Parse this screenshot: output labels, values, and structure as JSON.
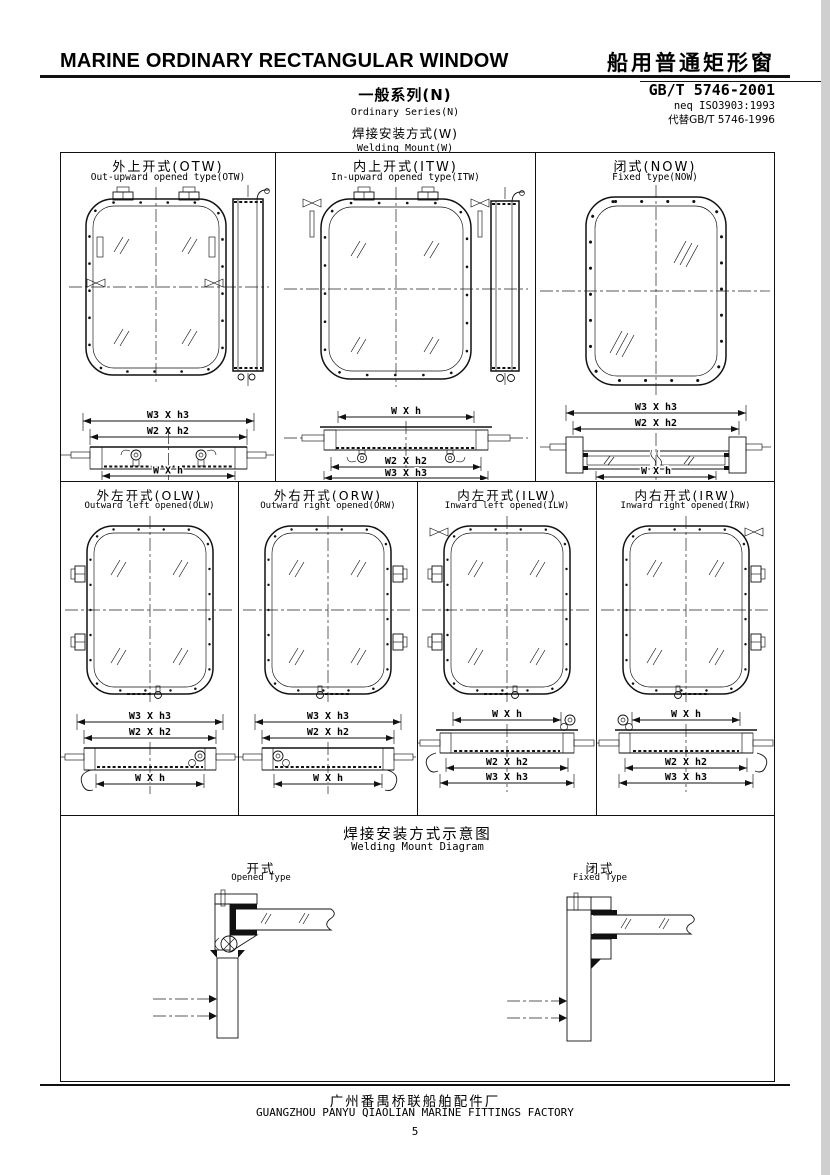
{
  "header": {
    "title_en": "MARINE ORDINARY RECTANGULAR WINDOW",
    "title_zh": "船用普通矩形窗",
    "standard_code": "GB/T 5746-2001",
    "standard_neq": "neq ISO3903:1993",
    "standard_replaces": "代替GB/T 5746-1996",
    "series_zh": "一般系列(N)",
    "series_en": "Ordinary Series(N)",
    "mount_zh": "焊接安装方式(W)",
    "mount_en": "Welding Mount(W)"
  },
  "dims": {
    "w3h3": "W3 X h3",
    "w2h2": "W2 X h2",
    "wh": "W X h"
  },
  "panels_row1": [
    {
      "title_zh": "外上开式(OTW)",
      "title_en": "Out-upward opened type(OTW)"
    },
    {
      "title_zh": "内上开式(ITW)",
      "title_en": "In-upward opened type(ITW)"
    },
    {
      "title_zh": "闭式(NOW)",
      "title_en": "Fixed type(NOW)"
    }
  ],
  "panels_row2": [
    {
      "title_zh": "外左开式(OLW)",
      "title_en": "Outward left opened(OLW)"
    },
    {
      "title_zh": "外右开式(ORW)",
      "title_en": "Outward right opened(ORW)"
    },
    {
      "title_zh": "内左开式(ILW)",
      "title_en": "Inward left opened(ILW)"
    },
    {
      "title_zh": "内右开式(IRW)",
      "title_en": "Inward right opened(IRW)"
    }
  ],
  "welding": {
    "title_zh": "焊接安装方式示意图",
    "title_en": "Welding Mount Diagram",
    "opened_zh": "开式",
    "opened_en": "Opened Type",
    "fixed_zh": "闭式",
    "fixed_en": "Fixed Type"
  },
  "footer": {
    "factory_zh": "广州番禺桥联船舶配件厂",
    "factory_en": "GUANGZHOU PANYU QIAOLIAN MARINE FITTINGS FACTORY",
    "page_number": "5"
  },
  "colors": {
    "ink": "#111111",
    "paper": "#ffffff",
    "edge_shadow": "#cfcfcf"
  }
}
